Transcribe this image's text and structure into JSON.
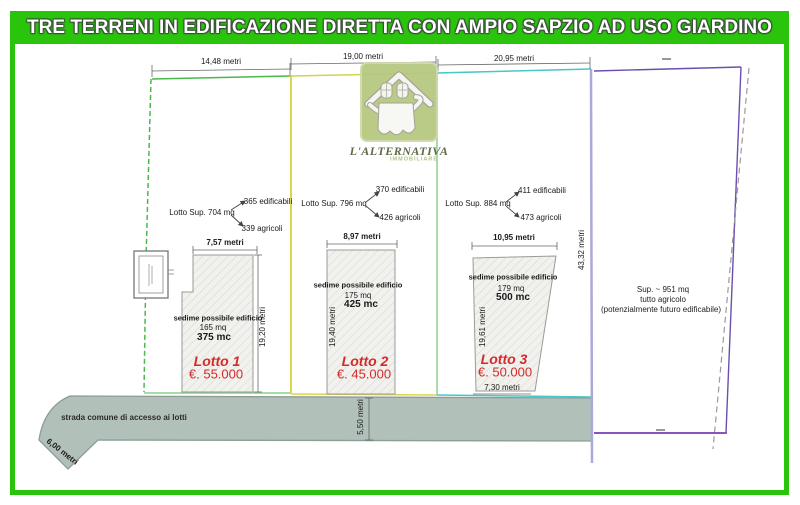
{
  "header": {
    "title": "TRE TERRENI IN EDIFICAZIONE DIRETTA CON AMPIO SAPZIO AD USO GIARDINO"
  },
  "logo": {
    "name": "L'ALTERNATIVA",
    "subtitle": "IMMOBILIARE"
  },
  "lots": [
    {
      "name": "Lotto 1",
      "price": "€. 55.000",
      "sup": "Lotto Sup. 704 mq",
      "edificabili": "365 edificabili",
      "agricoli": "339 agricoli",
      "sedime": "sedime possibile edificio",
      "area_mq": "165 mq",
      "volume_mc": "375 mc",
      "front": "14,48 metri",
      "width": "7,57 metri",
      "depth": "19,20 metri"
    },
    {
      "name": "Lotto 2",
      "price": "€. 45.000",
      "sup": "Lotto Sup. 796 mq",
      "edificabili": "370 edificabili",
      "agricoli": "426 agricoli",
      "sedime": "sedime possibile edificio",
      "area_mq": "175 mq",
      "volume_mc": "425 mc",
      "front": "19,00 metri",
      "width": "8,97 metri",
      "depth": "19,40 metri"
    },
    {
      "name": "Lotto 3",
      "price": "€. 50.000",
      "sup": "Lotto Sup. 884 mq",
      "edificabili": "411 edificabili",
      "agricoli": "473 agricoli",
      "sedime": "sedime possibile edificio",
      "area_mq": "179 mq",
      "volume_mc": "500 mc",
      "front": "20,95 metri",
      "width": "10,95 metri",
      "depth": "19,61 metri",
      "rear": "7,30 metri"
    }
  ],
  "agricultural_lot": {
    "sup": "Sup. ~ 951 mq",
    "use": "tutto agricolo",
    "note": "(potenzialmente futuro edificabile)",
    "side": "43,32 metri"
  },
  "road": {
    "label": "strada comune di accesso ai lotti",
    "width": "5,50 metri",
    "end_width": "6,00 metri"
  },
  "colors": {
    "frame_green": "#2bc40c",
    "lot1_green": "#4cb84c",
    "divider_yellow": "#ded44e",
    "divider_green": "#8fd08f",
    "lot3_teal": "#49c6c6",
    "agri_left_blue": "#a9a9da",
    "agri_purple": "#6a4fae",
    "road_gray": "#b2c0ba",
    "price_red": "#d42a2a",
    "logo_green": "#b5c87f"
  }
}
